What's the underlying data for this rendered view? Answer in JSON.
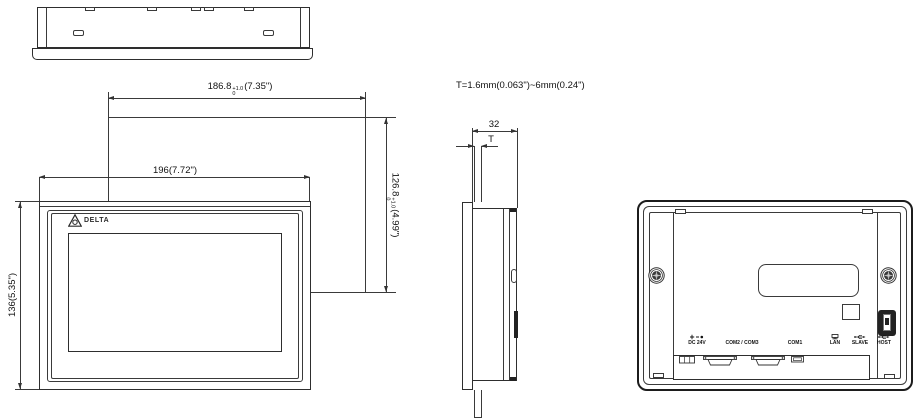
{
  "drawing": {
    "brand": "DELTA"
  },
  "dimensions": {
    "outer_width": "196(7.72\")",
    "outer_height": "136(5.35\")",
    "cutout_width_mm": "186.8",
    "cutout_width_tol_plus": "+1.0",
    "cutout_width_tol_minus": "0",
    "cutout_width_inch": "(7.35\")",
    "cutout_height_mm": "126.8",
    "cutout_height_tol_plus": "+1.0",
    "cutout_height_tol_minus": "0",
    "cutout_height_inch": "(4.99\")",
    "depth": "32",
    "panel_thickness_label": "T",
    "panel_thickness_note": "T=1.6mm(0.063\")~6mm(0.24\")"
  },
  "rear": {
    "ports": [
      {
        "label": "DC 24V"
      },
      {
        "label": "COM2 / COM3"
      },
      {
        "label": "COM1"
      },
      {
        "label": "LAN"
      },
      {
        "label": "SLAVE"
      },
      {
        "label": "HOST"
      }
    ]
  }
}
